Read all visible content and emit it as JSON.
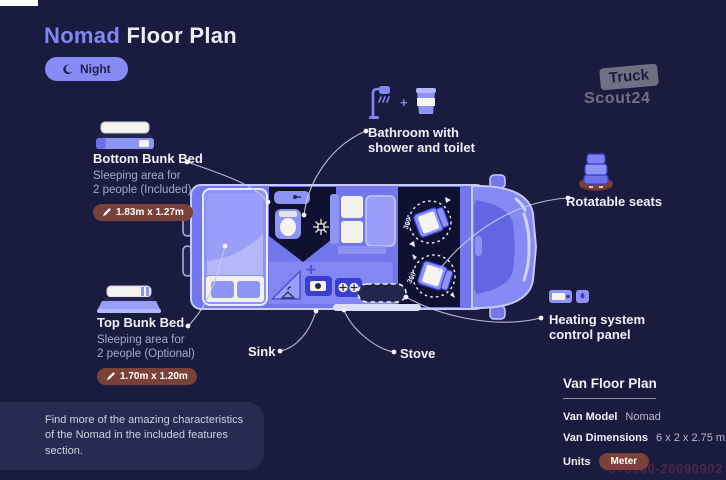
{
  "header": {
    "title_accent": "Nomad",
    "title_rest": " Floor Plan",
    "night_toggle": "Night"
  },
  "callouts": {
    "bottom_bunk": {
      "title": "Bottom Bunk Bed",
      "subtitle1": "Sleeping area for",
      "subtitle2": "2 people (Included)",
      "dimensions": "1.83m x 1.27m"
    },
    "top_bunk": {
      "title": "Top Bunk Bed",
      "subtitle1": "Sleeping area for",
      "subtitle2": "2 people (Optional)",
      "dimensions": "1.70m x 1.20m"
    },
    "bathroom": {
      "line1": "Bathroom with",
      "line2": "shower and toilet"
    },
    "rotatable_seats": {
      "label": "Rotatable seats"
    },
    "heating": {
      "line1": "Heating system",
      "line2": "control panel"
    },
    "sink": {
      "label": "Sink"
    },
    "stove": {
      "label": "Stove"
    },
    "plus_sign": "+"
  },
  "van": {
    "rotation_front": "360°",
    "rotation_rear": "360°"
  },
  "note": {
    "line1": "Find more of the amazing characteristics",
    "line2": "of the Nomad in the included features section."
  },
  "info_panel": {
    "title": "Van Floor Plan",
    "rows": [
      {
        "label": "Van Model",
        "value": "Nomad"
      },
      {
        "label": "Van Dimensions",
        "value": "6 x 2 x 2.75 m"
      },
      {
        "label": "Units",
        "value": "Meter"
      }
    ]
  },
  "brand": {
    "line1": "Truck",
    "line2": "Scout24"
  },
  "watermark_code": "573980-26090902",
  "colors": {
    "background": "#1a1c3f",
    "accent": "#8187f3",
    "van_body": "#7277ee",
    "dark_interior": "#0f1130",
    "dimension_pill": "#7a4138",
    "note_box": "#272b52"
  }
}
